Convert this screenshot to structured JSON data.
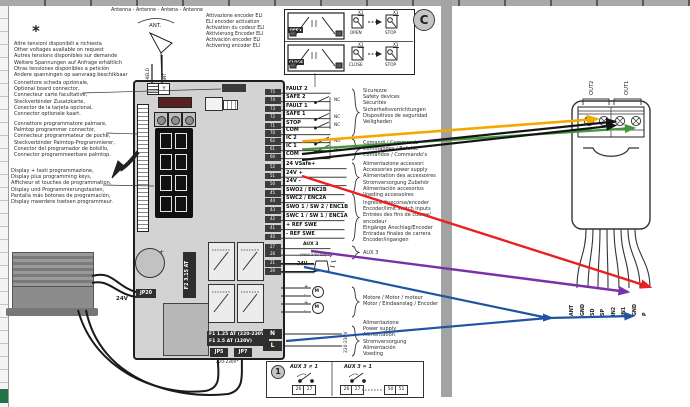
{
  "page": {
    "marker_c": "C",
    "asterisk": "*"
  },
  "notes": {
    "voltages": [
      "Altre tensioni disponibili a richiesta",
      "Other voltages available on request",
      "Autres tensions disponibles sur demande",
      "Weitere Spannungen auf Anfrage erhältlich",
      "Otras tensiones disponibles a petición",
      "Andere spanningen op aanvraag beschikbaar"
    ],
    "optional_board": [
      "Connettore scheda opzionale,",
      "Optional board connector,",
      "Connecteur carte facultative,",
      "Steckverbinder Zusatzkarte,",
      "Conector de la tarjeta opcional,",
      "Connector optionele kaart."
    ],
    "palmtop": [
      "Connettore programmatore palmare,",
      "Palmtop programmer connector,",
      "Connecteur programmateur de poche,",
      "Steckverbinder Palmtop-Programmierer,",
      "Conector del programador de bolsillo,",
      "Connector programmeerbare palmtop."
    ],
    "display_keys": [
      "Display + tasti programmazione,",
      "Display plus programming keys,",
      "Afficheur et touches de programmation,",
      "Display und Programmierungstasten,",
      "Pantalla más botones de programación,",
      "Display meerdere toetsen programmeur."
    ]
  },
  "antenna": {
    "title": "Antenna - Antenne - Antena - Antenne",
    "ant": "ANT.",
    "wire_shield": "SHIELD",
    "wire_ant": "ANT"
  },
  "eli": {
    "note": [
      "Attivazione encoder ELI",
      "ELI encoder activation",
      "Activation du codeur ELI",
      "Aktivierung Encoder ELI",
      "Activación encoder ELI",
      "Activering encoder ELI"
    ],
    "x1": "X1",
    "rows": [
      {
        "switch": "OPEN",
        "icon1": "OPEN",
        "icon2": "STOP"
      },
      {
        "switch": "CLOSE",
        "icon1": "CLOSE",
        "icon2": "STOP"
      }
    ]
  },
  "board": {
    "fuse2": "F2 3.15 AT",
    "jp20": "JP20",
    "wire_24v": "24V",
    "fuse1_line1": "F1 1.25 AT (220-230V)",
    "fuse1_line2": "F1 2.5 AT (120V)",
    "jp5": "JP5",
    "jp7": "JP7",
    "mains_note": "220-230V*"
  },
  "terminals": {
    "rows": [
      {
        "num": "75",
        "label": "FAULT 2"
      },
      {
        "num": "74",
        "label": "SAFE 2"
      },
      {
        "num": "73",
        "label": "FAULT 1"
      },
      {
        "num": "72",
        "label": "SAFE 1"
      },
      {
        "num": "71",
        "label": "STOP"
      },
      {
        "num": "70",
        "label": "COM"
      },
      {
        "num": "62",
        "label": "IC 2"
      },
      {
        "num": "61",
        "label": "IC 1"
      },
      {
        "num": "60",
        "label": "COM"
      },
      {
        "num": "52",
        "label": "24 VSafe+"
      },
      {
        "num": "51",
        "label": "24V +"
      },
      {
        "num": "50",
        "label": "24V -"
      },
      {
        "num": "45",
        "label": "SWO2 / ENC2B"
      },
      {
        "num": "44",
        "label": "SWC2 / ENC2A"
      },
      {
        "num": "43",
        "label": "SWO 1 / SW 2 / ENC1B"
      },
      {
        "num": "42",
        "label": "SWC 1 / SW 1 / ENC1A"
      },
      {
        "num": "41",
        "label": "+ REF SWE"
      },
      {
        "num": "40",
        "label": "- REF SWE"
      },
      {
        "num": "27",
        "label": ""
      },
      {
        "num": "26",
        "label": ""
      },
      {
        "num": "21",
        "label": ""
      },
      {
        "num": "20",
        "label": ""
      }
    ],
    "nc": "NC",
    "no": "NO",
    "aux3": "AUX 3",
    "aux3_sub": "(MAX 24V 1A)",
    "lamp": "24V",
    "motor_m": "M",
    "motor_signs": [
      "+",
      "-",
      "+",
      "-"
    ],
    "n": "N",
    "l": "L",
    "mains_vertical": "220-230V"
  },
  "groups": {
    "safety": [
      "Sicurezze",
      "Safety devices",
      "Sécurités",
      "Sicherheitsvorrichtungen",
      "Dispositivos de seguridad",
      "Veiligheden"
    ],
    "commands": [
      "Comandi / Commands",
      "Commandes / Befehle",
      "Comandos / Commando's"
    ],
    "acc_power": [
      "Alimentazione accessori",
      "Accessories power supply",
      "Alimentation des accessoires",
      "Stromversorgung Zubehör",
      "Alimentación accesorios",
      "Voeding accessoires"
    ],
    "enc_inputs": [
      "Ingressi finecorsa/encoder",
      "Encoder/limit switch inputs",
      "Entrées des fins de course/",
      "encodeur",
      "Eingänge Anschlag/Encoder",
      "Entradas finales de carrera",
      "Encoder/ingangen"
    ],
    "aux": "AUX 3",
    "motor": [
      "Motore / Motor / moteur",
      "Motor / Eindaanslag / Encoder"
    ],
    "power": [
      "Alimentazione",
      "Power supply",
      "Alimentation",
      "Stromversorgung",
      "Alimentación",
      "Voeding"
    ]
  },
  "connector": {
    "out2": "OUT2",
    "out1": "OUT1",
    "b": "B",
    "pins": [
      "ANT",
      "GND",
      "SD",
      "SP",
      "IN2",
      "IN1",
      "GND",
      "P"
    ]
  },
  "footer": {
    "marker": "1",
    "left_cond": "AUX 3 ≠ 1",
    "right_cond": "AUX 3 = 1",
    "cells_left": [
      "26",
      "27"
    ],
    "cells_mid": [
      "26",
      "27"
    ],
    "cells_right": [
      "50",
      "51"
    ]
  },
  "colors": {
    "yellow": "#f2a900",
    "green": "#43963c",
    "black": "#151515",
    "red": "#e82020",
    "purple": "#7b2fa8",
    "blue": "#2155a3"
  }
}
